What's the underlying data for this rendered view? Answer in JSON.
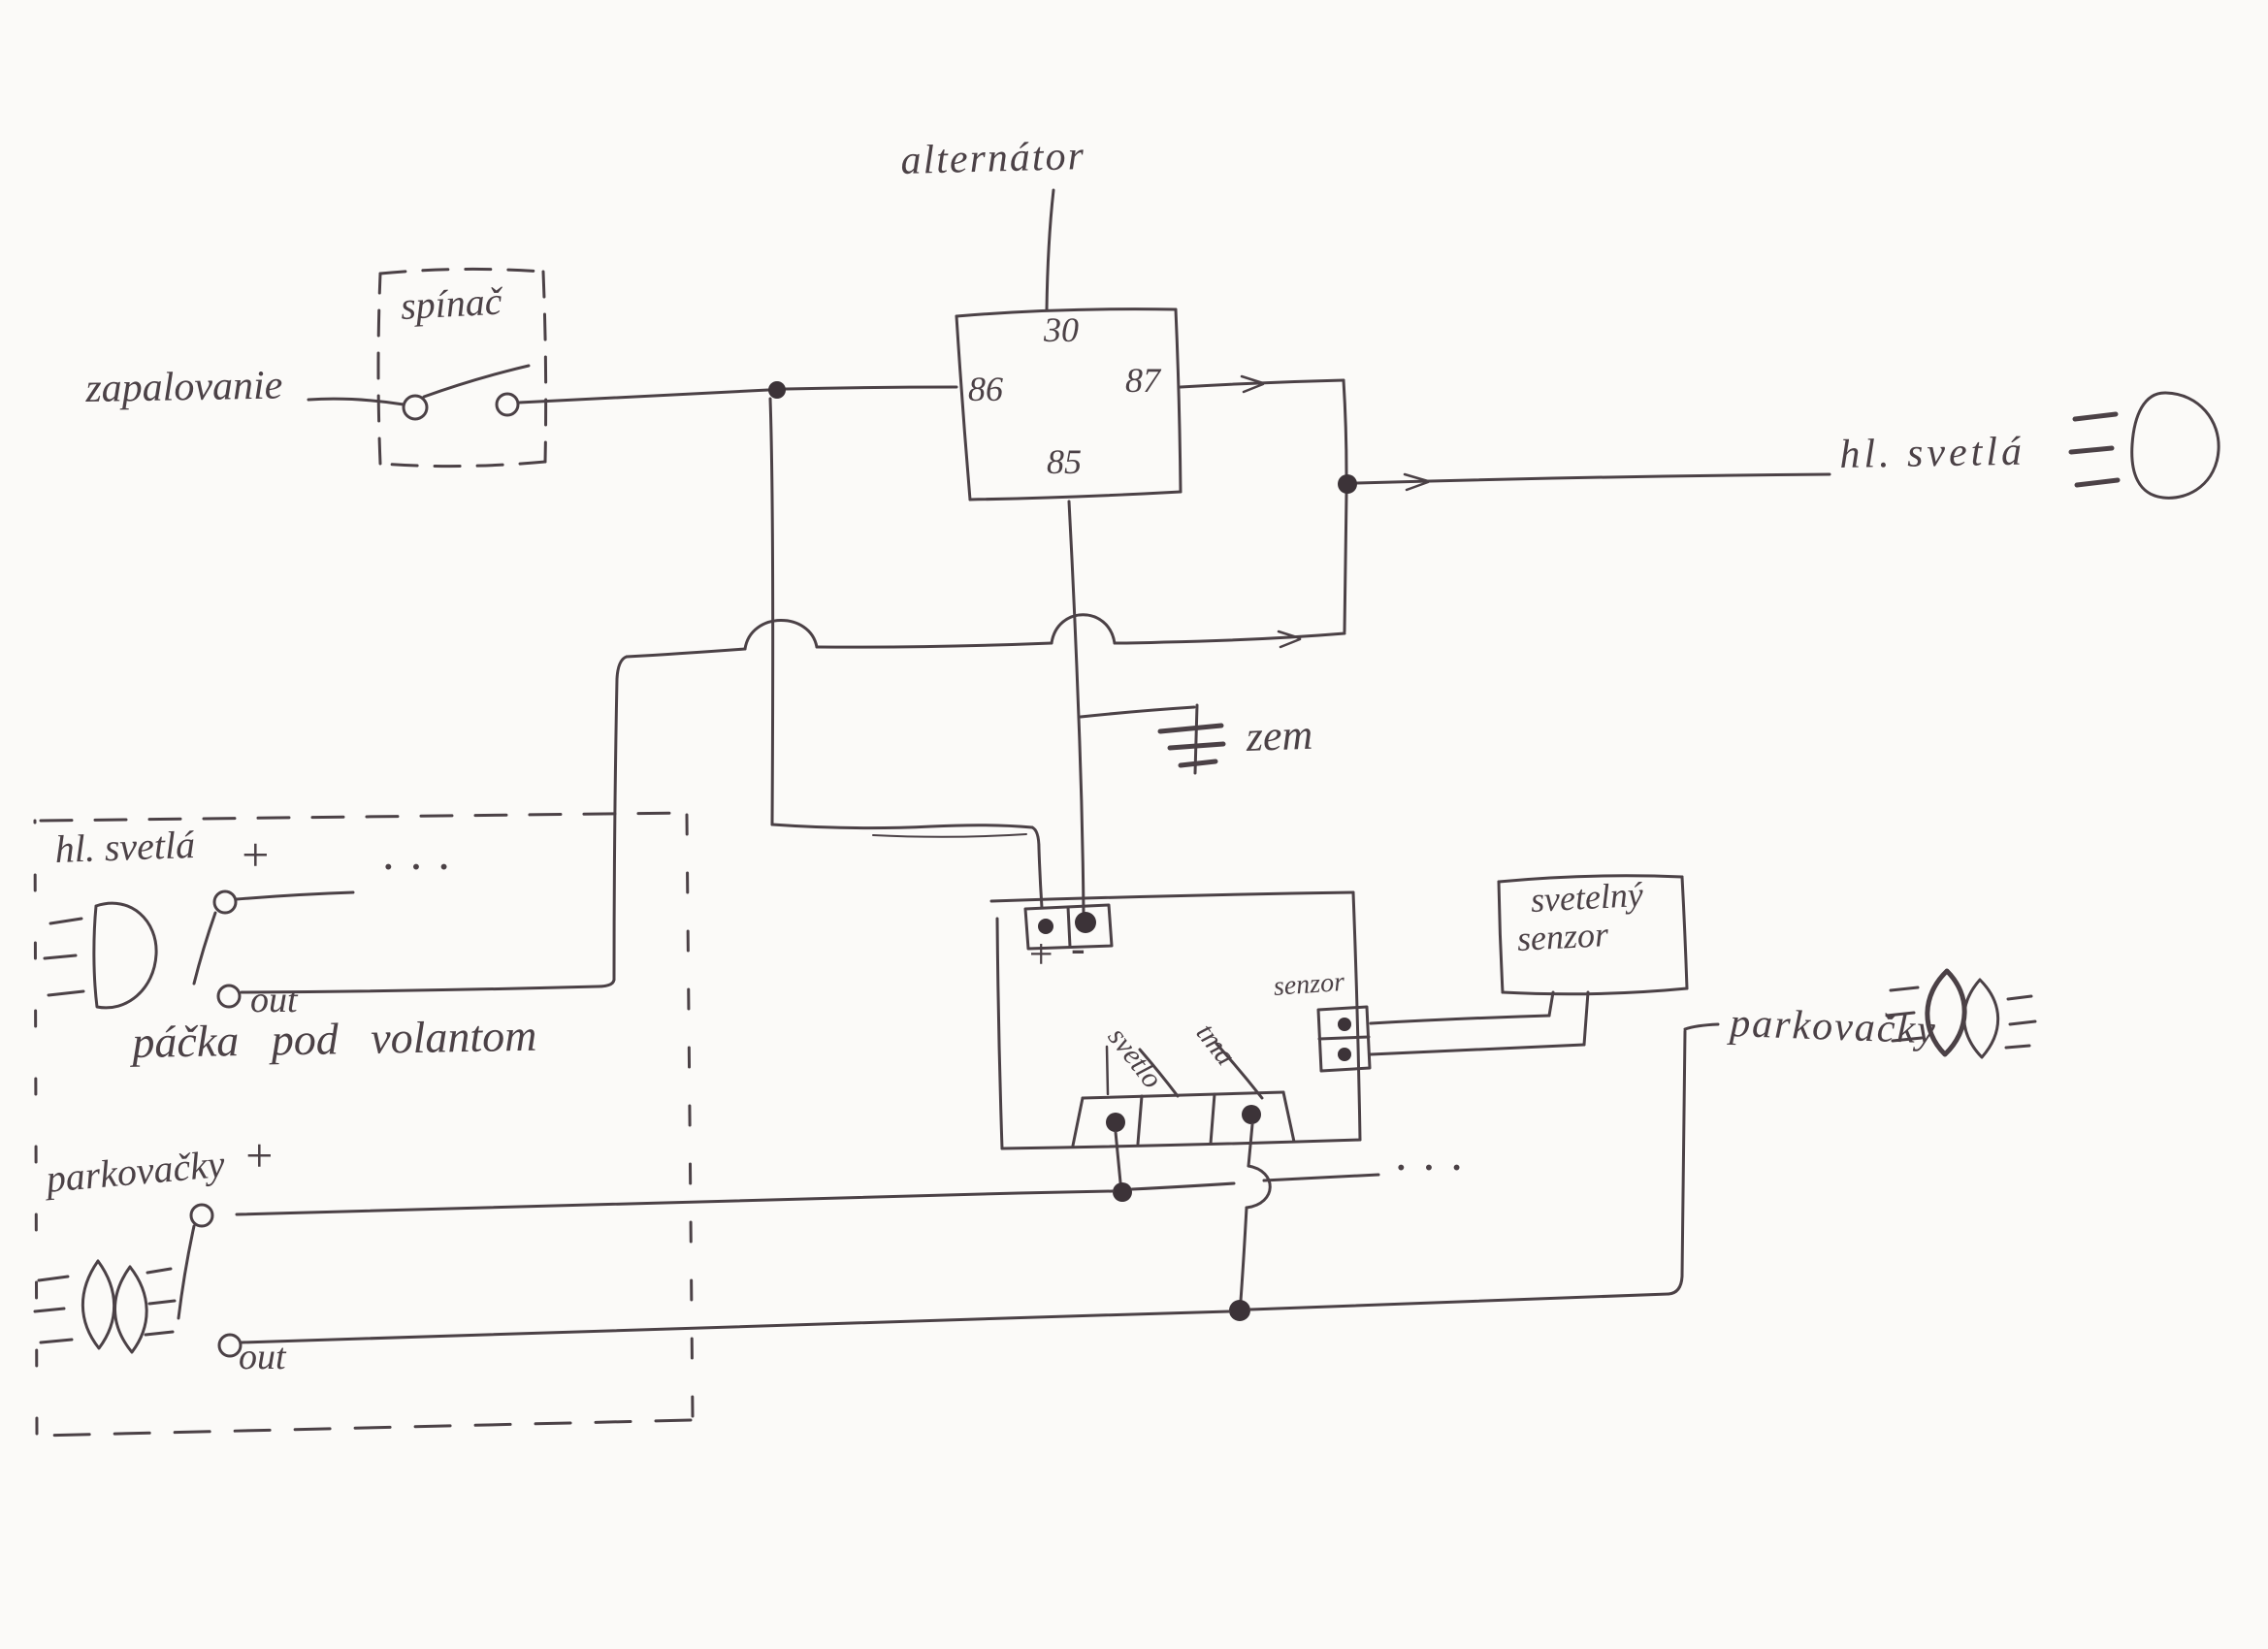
{
  "colors": {
    "ink": "#4b4146",
    "ink_dark": "#3c3338",
    "paper": "#fbfaf8"
  },
  "top": {
    "alternator": "alternátor",
    "ignition": "zapalovanie",
    "switch_box": "spínač",
    "relay": {
      "top": "30",
      "left": "86",
      "right": "87",
      "bottom": "85"
    },
    "headlights": "hl. svetlá",
    "ground": "zem"
  },
  "sensor_box": {
    "line1": "svetelný",
    "line2": "senzor"
  },
  "module": {
    "plus": "+",
    "minus": "-",
    "sensor": "senzor",
    "light": "svetlo",
    "dark": "tma"
  },
  "stalk_box": {
    "headlights": "hl. svetlá",
    "plus_top": "+",
    "out_top": "out",
    "label": "páčka pod volantom",
    "parking": "parkovačky",
    "plus_bottom": "+",
    "out_bottom": "out",
    "dots": "···"
  },
  "right": {
    "parking": "parkovačky",
    "dots": "···"
  }
}
